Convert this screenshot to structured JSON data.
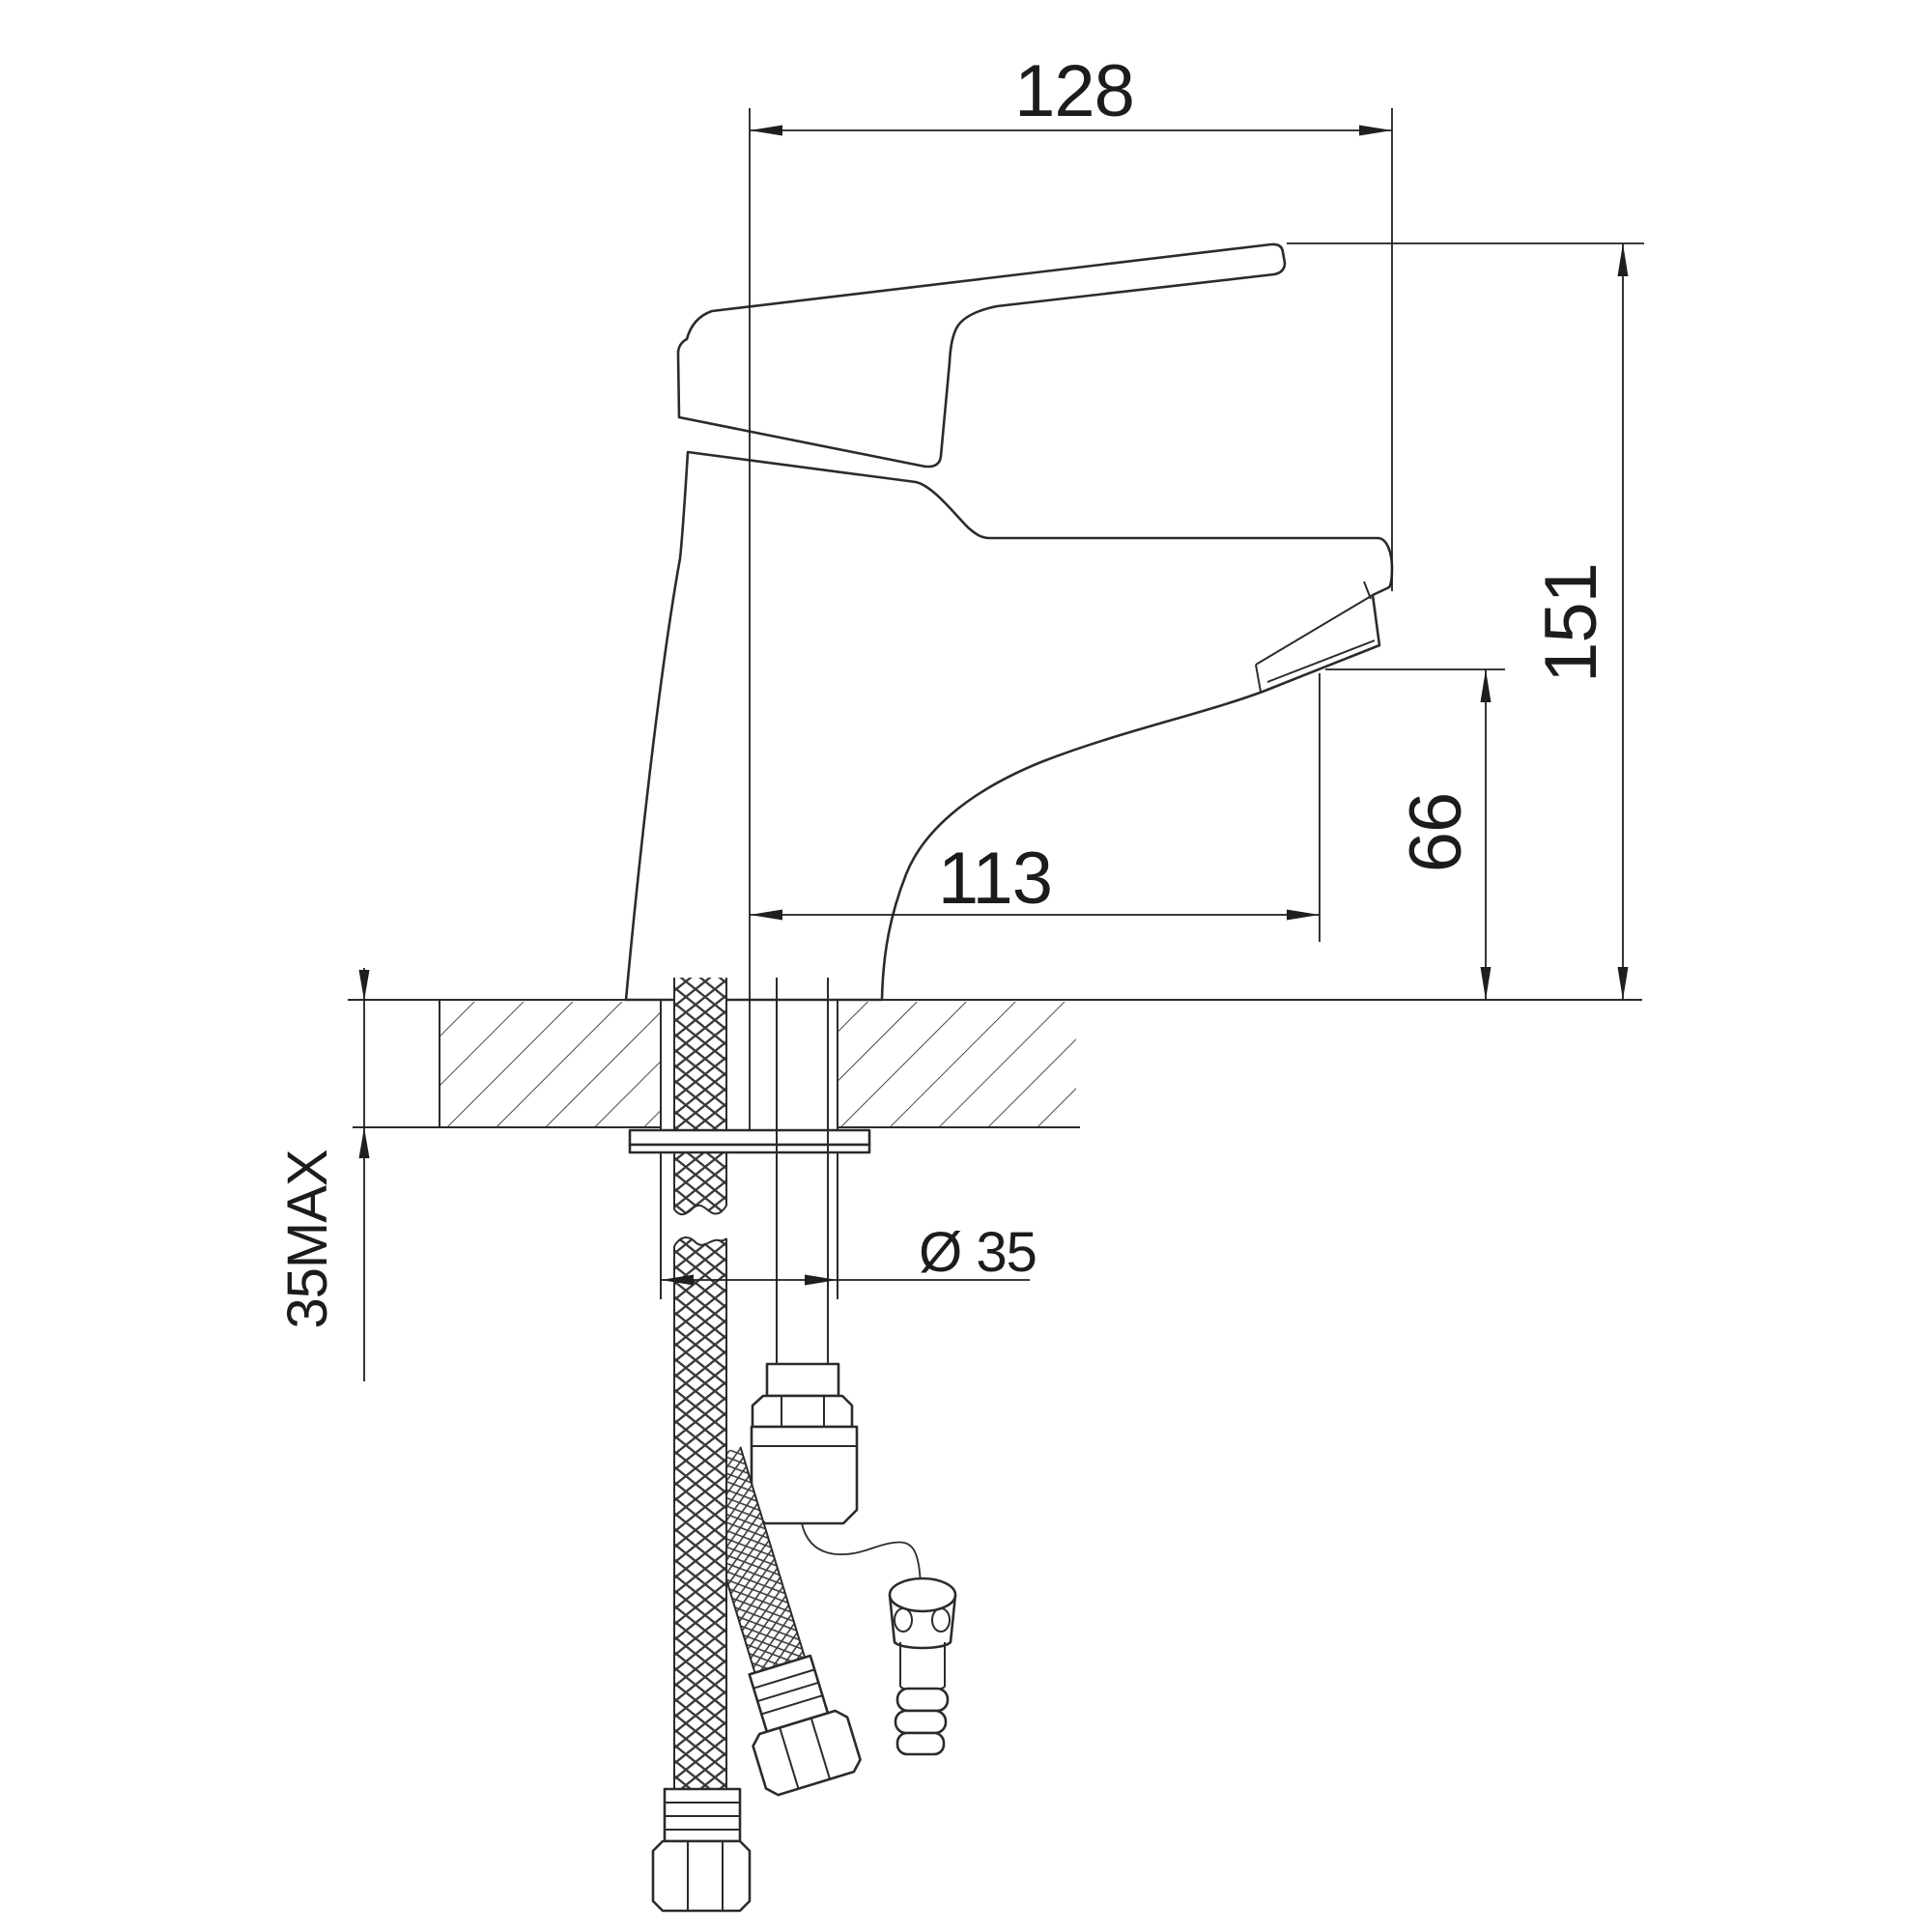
{
  "drawing": {
    "subject": "basin mixer faucet installation diagram, side section view",
    "background": "#ffffff",
    "line_color": "#2b2b2b",
    "dimensions": {
      "top_width": "128",
      "overall_height": "151",
      "spout_reach": "113",
      "spout_height": "66",
      "deck_thickness": "35MAX",
      "hole_diameter": "Ø 35"
    }
  }
}
